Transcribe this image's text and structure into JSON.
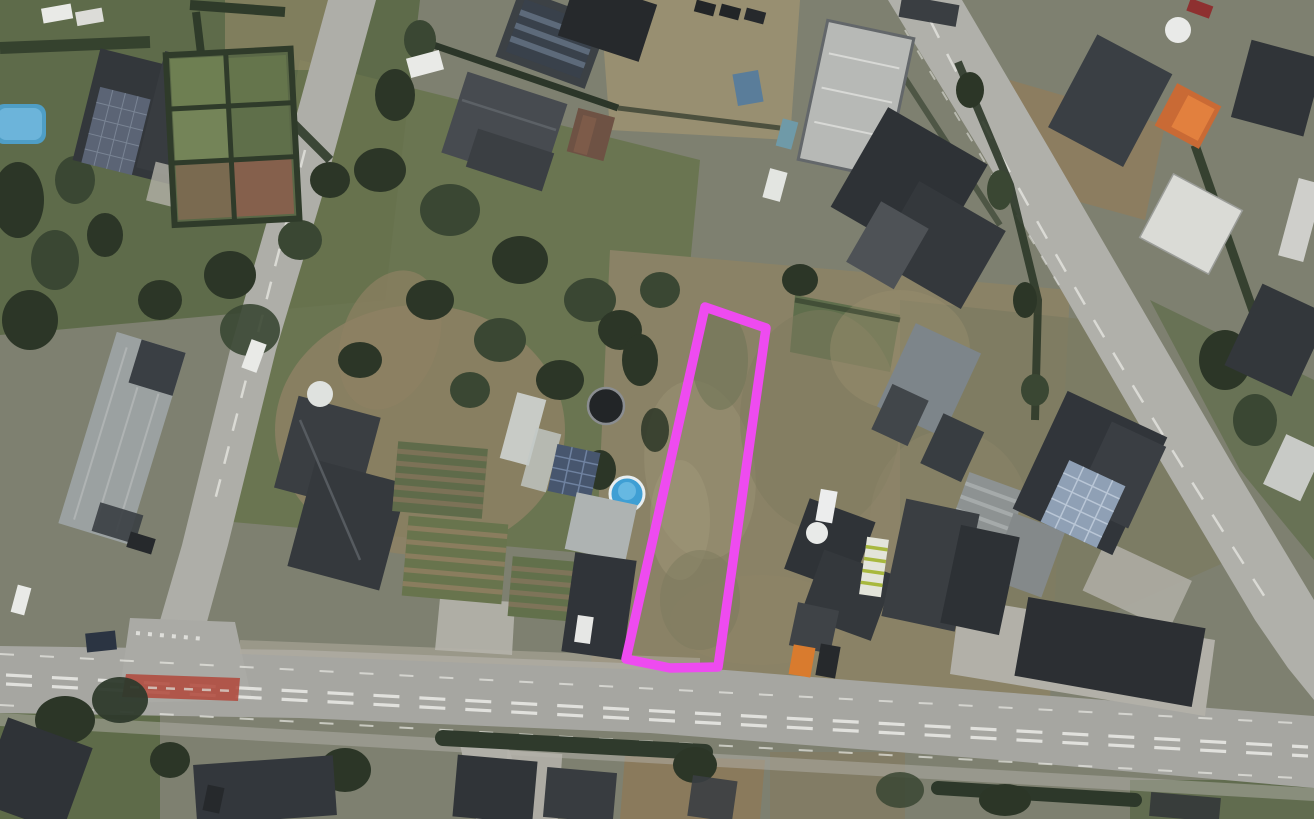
{
  "map": {
    "view_type": "satellite aerial imagery",
    "scene": "suburban neighborhood with houses, gardens, two diagonal side roads and a main road along the bottom",
    "visible_text": []
  },
  "colors": {
    "parcel_highlight": "#ee4bf0",
    "main_road": "#a6a6a1",
    "red_cycle_lane": "#b04a3e",
    "pool_blue": "#44a0d2",
    "orange_container": "#d97b2e"
  },
  "parcel": {
    "label": "highlighted-plot",
    "points": "705,307 766,328 718,667 670,668 626,659",
    "stroke_width": 9.5,
    "color": "#ee4bf0"
  }
}
